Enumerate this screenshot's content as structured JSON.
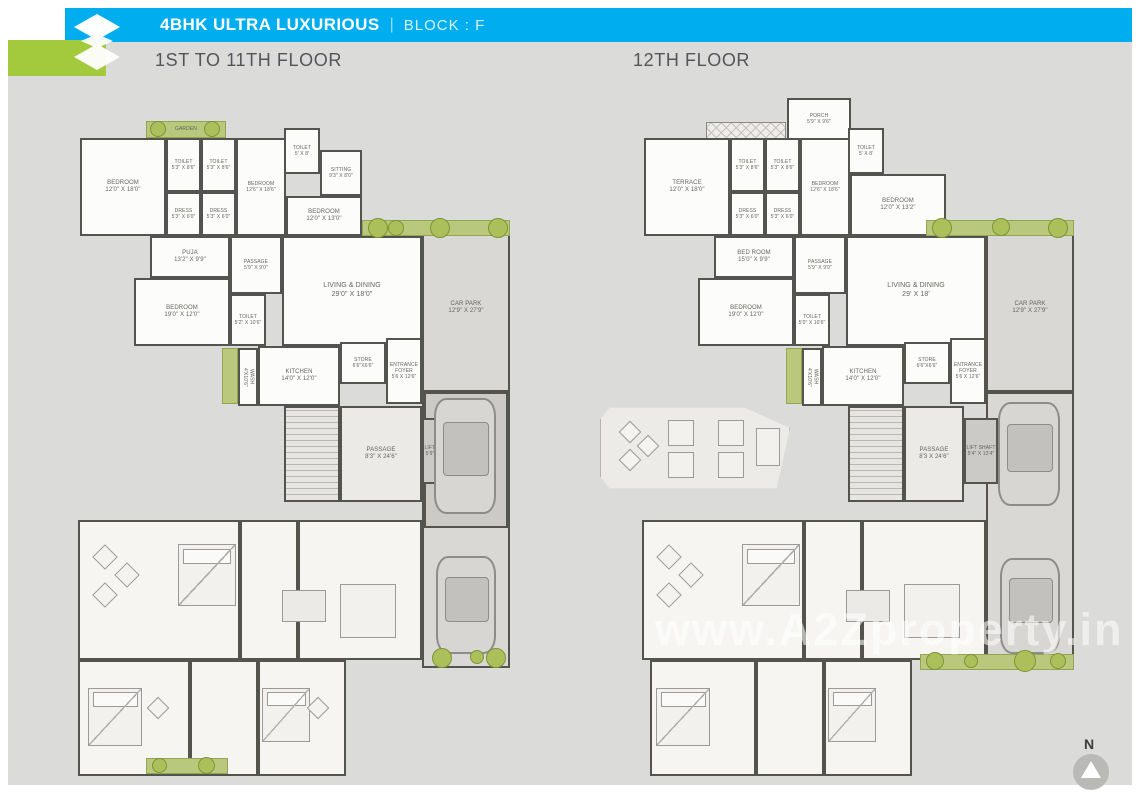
{
  "colors": {
    "header_blue": "#00adef",
    "logo_green": "#a3c93d",
    "canvas_gray": "#dbdbd9",
    "accent_green": "#abc05a",
    "wall": "#54544f"
  },
  "header": {
    "title": "4BHK ULTRA LUXURIOUS",
    "separator": "|",
    "block_label": "BLOCK : F"
  },
  "compass": {
    "label": "N"
  },
  "watermark": {
    "text": "www.A2Zproperty.in"
  },
  "plans": [
    {
      "id": "first-to-11th-floor",
      "title": "1ST TO 11TH FLOOR",
      "items": [
        {
          "k": "zone",
          "n": "CAR PARK",
          "d": "12'9\" X 27'9\"",
          "x": 422,
          "y": 224,
          "w": 88,
          "h": 168
        },
        {
          "k": "zone",
          "x": 422,
          "y": 392,
          "w": 88,
          "h": 276
        },
        {
          "k": "dark",
          "x": 424,
          "y": 392,
          "w": 84,
          "h": 136
        },
        {
          "k": "stairs",
          "x": 284,
          "y": 406,
          "w": 56,
          "h": 96
        },
        {
          "k": "pass",
          "n": "PASSAGE",
          "d": "8'3\" X 24'6\"",
          "x": 340,
          "y": 406,
          "w": 82,
          "h": 96
        },
        {
          "k": "dark",
          "n": "LIFT SHAFT",
          "d": "5'9\" X 12'6\"",
          "x": 422,
          "y": 418,
          "w": 34,
          "h": 66,
          "fs": 5
        },
        {
          "k": "green",
          "n": "GARDEN",
          "x": 146,
          "y": 121,
          "w": 80,
          "h": 17,
          "fs": 5
        },
        {
          "k": "room",
          "n": "BEDROOM",
          "d": "12'0\" X 18'0\"",
          "x": 80,
          "y": 138,
          "w": 86,
          "h": 98
        },
        {
          "k": "room",
          "n": "TOILET",
          "d": "5'3\" X 8'6\"",
          "x": 166,
          "y": 138,
          "w": 35,
          "h": 54,
          "fs": 5
        },
        {
          "k": "room",
          "n": "TOILET",
          "d": "5'3\" X 8'6\"",
          "x": 201,
          "y": 138,
          "w": 35,
          "h": 54,
          "fs": 5
        },
        {
          "k": "room",
          "n": "DRESS",
          "d": "5'3\" X 6'0\"",
          "x": 166,
          "y": 192,
          "w": 35,
          "h": 44,
          "fs": 5
        },
        {
          "k": "room",
          "n": "DRESS",
          "d": "5'3\" X 6'0\"",
          "x": 201,
          "y": 192,
          "w": 35,
          "h": 44,
          "fs": 5
        },
        {
          "k": "room",
          "n": "BEDROOM",
          "d": "12'6\" X 18'6\"",
          "x": 236,
          "y": 138,
          "w": 50,
          "h": 98,
          "fs": 5
        },
        {
          "k": "room",
          "n": "BEDROOM",
          "d": "12'0\" X 13'0\"",
          "x": 286,
          "y": 196,
          "w": 76,
          "h": 40
        },
        {
          "k": "room",
          "n": "TOILET",
          "d": "5' X 8'",
          "x": 284,
          "y": 128,
          "w": 36,
          "h": 46,
          "fs": 5
        },
        {
          "k": "room",
          "n": "SITTING",
          "d": "9'3\" X 8'0\"",
          "x": 320,
          "y": 150,
          "w": 42,
          "h": 46,
          "fs": 5
        },
        {
          "k": "room",
          "n": "PUJA",
          "d": "13'2\" X 9'9\"",
          "x": 150,
          "y": 236,
          "w": 80,
          "h": 42
        },
        {
          "k": "room",
          "n": "PASSAGE",
          "d": "5'9\" X 9'0\"",
          "x": 230,
          "y": 236,
          "w": 52,
          "h": 58,
          "fs": 5
        },
        {
          "k": "room",
          "n": "LIVING & DINING",
          "d": "29'0\" X 18'0\"",
          "x": 282,
          "y": 236,
          "w": 140,
          "h": 110,
          "fs": 7
        },
        {
          "k": "room",
          "n": "BEDROOM",
          "d": "19'0\" X 12'0\"",
          "x": 134,
          "y": 278,
          "w": 96,
          "h": 68
        },
        {
          "k": "room",
          "n": "TOILET",
          "d": "5'2\" X 10'6\"",
          "x": 230,
          "y": 294,
          "w": 36,
          "h": 52,
          "fs": 5
        },
        {
          "k": "green",
          "x": 222,
          "y": 348,
          "w": 16,
          "h": 56
        },
        {
          "k": "room",
          "n": "WASH",
          "d": "4'X10'6\"",
          "x": 238,
          "y": 348,
          "w": 20,
          "h": 58,
          "vert": true,
          "fs": 5
        },
        {
          "k": "room",
          "n": "KITCHEN",
          "d": "14'0\" X 12'0\"",
          "x": 258,
          "y": 346,
          "w": 82,
          "h": 60
        },
        {
          "k": "room",
          "n": "STORE",
          "d": "6'6\"X6'6\"",
          "x": 340,
          "y": 342,
          "w": 46,
          "h": 42,
          "fs": 5
        },
        {
          "k": "room",
          "n": "ENTRANCE FOYER",
          "d": "5'6 X 12'6\"",
          "x": 386,
          "y": 338,
          "w": 36,
          "h": 66,
          "fs": 5
        },
        {
          "k": "label",
          "n": "CAR LIFT",
          "d": "20.5 X 12'9\"",
          "x": 426,
          "y": 484,
          "w": 80,
          "h": 20,
          "fs": 5
        },
        {
          "k": "soft",
          "x": 78,
          "y": 520,
          "w": 162,
          "h": 140
        },
        {
          "k": "soft",
          "x": 240,
          "y": 520,
          "w": 58,
          "h": 140
        },
        {
          "k": "soft",
          "x": 298,
          "y": 520,
          "w": 124,
          "h": 140
        },
        {
          "k": "soft",
          "x": 78,
          "y": 660,
          "w": 112,
          "h": 116
        },
        {
          "k": "soft",
          "x": 190,
          "y": 660,
          "w": 68,
          "h": 116
        },
        {
          "k": "soft",
          "x": 258,
          "y": 660,
          "w": 88,
          "h": 116
        },
        {
          "k": "bed",
          "x": 178,
          "y": 544,
          "w": 58,
          "h": 62
        },
        {
          "k": "dia",
          "x": 96,
          "y": 548,
          "w": 18,
          "h": 18
        },
        {
          "k": "dia",
          "x": 118,
          "y": 566,
          "w": 18,
          "h": 18
        },
        {
          "k": "dia",
          "x": 96,
          "y": 586,
          "w": 18,
          "h": 18
        },
        {
          "k": "table",
          "x": 282,
          "y": 590,
          "w": 44,
          "h": 32
        },
        {
          "k": "furn",
          "x": 340,
          "y": 584,
          "w": 56,
          "h": 54
        },
        {
          "k": "bed",
          "x": 88,
          "y": 688,
          "w": 54,
          "h": 58
        },
        {
          "k": "bed",
          "x": 262,
          "y": 688,
          "w": 48,
          "h": 54
        },
        {
          "k": "dia",
          "x": 150,
          "y": 700,
          "w": 16,
          "h": 16
        },
        {
          "k": "dia",
          "x": 310,
          "y": 700,
          "w": 16,
          "h": 16
        },
        {
          "k": "car",
          "x": 434,
          "y": 398,
          "w": 62,
          "h": 116
        },
        {
          "k": "car",
          "x": 436,
          "y": 556,
          "w": 60,
          "h": 98
        },
        {
          "k": "green",
          "x": 362,
          "y": 220,
          "w": 148,
          "h": 16
        },
        {
          "k": "dot",
          "x": 368,
          "y": 218,
          "w": 20,
          "h": 20
        },
        {
          "k": "dot",
          "x": 388,
          "y": 220,
          "w": 16,
          "h": 16
        },
        {
          "k": "dot",
          "x": 430,
          "y": 218,
          "w": 20,
          "h": 20
        },
        {
          "k": "dot",
          "x": 488,
          "y": 218,
          "w": 20,
          "h": 20
        },
        {
          "k": "dot",
          "x": 150,
          "y": 121,
          "w": 16,
          "h": 16
        },
        {
          "k": "dot",
          "x": 204,
          "y": 121,
          "w": 16,
          "h": 16
        },
        {
          "k": "dot",
          "x": 432,
          "y": 648,
          "w": 20,
          "h": 20
        },
        {
          "k": "dot",
          "x": 470,
          "y": 650,
          "w": 14,
          "h": 14
        },
        {
          "k": "dot",
          "x": 486,
          "y": 648,
          "w": 20,
          "h": 20
        },
        {
          "k": "green",
          "x": 146,
          "y": 758,
          "w": 82,
          "h": 16
        },
        {
          "k": "dot",
          "x": 152,
          "y": 758,
          "w": 15,
          "h": 15
        },
        {
          "k": "dot",
          "x": 198,
          "y": 757,
          "w": 17,
          "h": 17
        }
      ]
    },
    {
      "id": "twelfth-floor",
      "title": "12TH FLOOR",
      "items": [
        {
          "k": "zone",
          "n": "CAR PARK",
          "d": "12'9\" X 27'9\"",
          "x": 986,
          "y": 224,
          "w": 88,
          "h": 168
        },
        {
          "k": "zone",
          "x": 986,
          "y": 392,
          "w": 88,
          "h": 276
        },
        {
          "k": "stairs",
          "x": 848,
          "y": 406,
          "w": 56,
          "h": 96
        },
        {
          "k": "pass",
          "n": "PASSAGE",
          "d": "8'3 X 24'6\"",
          "x": 904,
          "y": 406,
          "w": 60,
          "h": 96
        },
        {
          "k": "dark",
          "n": "LIFT SHAFT",
          "d": "5'4\" X 13'4\"",
          "x": 964,
          "y": 418,
          "w": 34,
          "h": 66,
          "fs": 5
        },
        {
          "k": "deck",
          "x": 600,
          "y": 406,
          "w": 190,
          "h": 84
        },
        {
          "k": "dia",
          "x": 622,
          "y": 424,
          "w": 16,
          "h": 16
        },
        {
          "k": "dia",
          "x": 640,
          "y": 438,
          "w": 16,
          "h": 16
        },
        {
          "k": "dia",
          "x": 622,
          "y": 452,
          "w": 16,
          "h": 16
        },
        {
          "k": "furn",
          "x": 668,
          "y": 420,
          "w": 26,
          "h": 26
        },
        {
          "k": "furn",
          "x": 718,
          "y": 420,
          "w": 26,
          "h": 26
        },
        {
          "k": "furn",
          "x": 668,
          "y": 452,
          "w": 26,
          "h": 26
        },
        {
          "k": "furn",
          "x": 718,
          "y": 452,
          "w": 26,
          "h": 26
        },
        {
          "k": "furn",
          "x": 756,
          "y": 428,
          "w": 24,
          "h": 38
        },
        {
          "k": "hatchx",
          "x": 706,
          "y": 122,
          "w": 80,
          "h": 18
        },
        {
          "k": "room",
          "n": "PORCH",
          "d": "5'9\" X 9'6\"",
          "x": 787,
          "y": 98,
          "w": 64,
          "h": 42,
          "fs": 5
        },
        {
          "k": "room",
          "n": "TERRACE",
          "d": "12'0\" X 18'0\"",
          "x": 644,
          "y": 138,
          "w": 86,
          "h": 98
        },
        {
          "k": "room",
          "n": "TOILET",
          "d": "5'3\" X 8'6\"",
          "x": 730,
          "y": 138,
          "w": 35,
          "h": 54,
          "fs": 5
        },
        {
          "k": "room",
          "n": "TOILET",
          "d": "5'3\" X 8'6\"",
          "x": 765,
          "y": 138,
          "w": 35,
          "h": 54,
          "fs": 5
        },
        {
          "k": "room",
          "n": "DRESS",
          "d": "5'3\" X 6'0\"",
          "x": 730,
          "y": 192,
          "w": 35,
          "h": 44,
          "fs": 5
        },
        {
          "k": "room",
          "n": "DRESS",
          "d": "5'3\" X 6'0\"",
          "x": 765,
          "y": 192,
          "w": 35,
          "h": 44,
          "fs": 5
        },
        {
          "k": "room",
          "n": "BEDROOM",
          "d": "12'6\" X 18'6\"",
          "x": 800,
          "y": 138,
          "w": 50,
          "h": 98,
          "fs": 5
        },
        {
          "k": "room",
          "n": "BEDROOM",
          "d": "12'0\" X 13'2\"",
          "x": 850,
          "y": 174,
          "w": 96,
          "h": 62
        },
        {
          "k": "room",
          "n": "TOILET",
          "d": "5' X 8'",
          "x": 848,
          "y": 128,
          "w": 36,
          "h": 46,
          "fs": 5
        },
        {
          "k": "room",
          "n": "BED ROOM",
          "d": "15'0\" X 9'9\"",
          "x": 714,
          "y": 236,
          "w": 80,
          "h": 42
        },
        {
          "k": "room",
          "n": "PASSAGE",
          "d": "5'9\" X 9'0\"",
          "x": 794,
          "y": 236,
          "w": 52,
          "h": 58,
          "fs": 5
        },
        {
          "k": "room",
          "n": "LIVING & DINING",
          "d": "29' X 18'",
          "x": 846,
          "y": 236,
          "w": 140,
          "h": 110,
          "fs": 7
        },
        {
          "k": "room",
          "n": "BEDROOM",
          "d": "19'0\" X 12'0\"",
          "x": 698,
          "y": 278,
          "w": 96,
          "h": 68
        },
        {
          "k": "room",
          "n": "TOILET",
          "d": "5'0\" X 10'6\"",
          "x": 794,
          "y": 294,
          "w": 36,
          "h": 52,
          "fs": 5
        },
        {
          "k": "green",
          "x": 786,
          "y": 348,
          "w": 16,
          "h": 56
        },
        {
          "k": "room",
          "n": "WASH",
          "d": "4'X10'6\"",
          "x": 802,
          "y": 348,
          "w": 20,
          "h": 58,
          "vert": true,
          "fs": 5
        },
        {
          "k": "room",
          "n": "KITCHEN",
          "d": "14'0\" X 12'0\"",
          "x": 822,
          "y": 346,
          "w": 82,
          "h": 60
        },
        {
          "k": "room",
          "n": "STORE",
          "d": "6'6\"X6'6\"",
          "x": 904,
          "y": 342,
          "w": 46,
          "h": 42,
          "fs": 5
        },
        {
          "k": "room",
          "n": "ENTRANCE FOYER",
          "d": "5'6 X 12'6\"",
          "x": 950,
          "y": 338,
          "w": 36,
          "h": 66,
          "fs": 5
        },
        {
          "k": "soft",
          "x": 642,
          "y": 520,
          "w": 162,
          "h": 140
        },
        {
          "k": "soft",
          "x": 804,
          "y": 520,
          "w": 58,
          "h": 140
        },
        {
          "k": "soft",
          "x": 862,
          "y": 520,
          "w": 124,
          "h": 140
        },
        {
          "k": "soft",
          "x": 650,
          "y": 660,
          "w": 106,
          "h": 116
        },
        {
          "k": "soft",
          "x": 756,
          "y": 660,
          "w": 68,
          "h": 116
        },
        {
          "k": "soft",
          "x": 824,
          "y": 660,
          "w": 88,
          "h": 116
        },
        {
          "k": "bed",
          "x": 742,
          "y": 544,
          "w": 58,
          "h": 62
        },
        {
          "k": "dia",
          "x": 660,
          "y": 548,
          "w": 18,
          "h": 18
        },
        {
          "k": "dia",
          "x": 682,
          "y": 566,
          "w": 18,
          "h": 18
        },
        {
          "k": "dia",
          "x": 660,
          "y": 586,
          "w": 18,
          "h": 18
        },
        {
          "k": "table",
          "x": 846,
          "y": 590,
          "w": 44,
          "h": 32
        },
        {
          "k": "furn",
          "x": 904,
          "y": 584,
          "w": 56,
          "h": 54
        },
        {
          "k": "bed",
          "x": 656,
          "y": 688,
          "w": 54,
          "h": 58
        },
        {
          "k": "bed",
          "x": 828,
          "y": 688,
          "w": 48,
          "h": 54
        },
        {
          "k": "car",
          "x": 998,
          "y": 402,
          "w": 62,
          "h": 104
        },
        {
          "k": "car",
          "x": 1000,
          "y": 558,
          "w": 60,
          "h": 96
        },
        {
          "k": "green",
          "x": 926,
          "y": 220,
          "w": 148,
          "h": 16
        },
        {
          "k": "dot",
          "x": 932,
          "y": 218,
          "w": 20,
          "h": 20
        },
        {
          "k": "dot",
          "x": 992,
          "y": 218,
          "w": 18,
          "h": 18
        },
        {
          "k": "dot",
          "x": 1048,
          "y": 218,
          "w": 20,
          "h": 20
        },
        {
          "k": "green",
          "x": 920,
          "y": 654,
          "w": 154,
          "h": 16
        },
        {
          "k": "dot",
          "x": 926,
          "y": 652,
          "w": 18,
          "h": 18
        },
        {
          "k": "dot",
          "x": 964,
          "y": 654,
          "w": 14,
          "h": 14
        },
        {
          "k": "dot",
          "x": 1014,
          "y": 650,
          "w": 22,
          "h": 22
        },
        {
          "k": "dot",
          "x": 1050,
          "y": 653,
          "w": 16,
          "h": 16
        }
      ]
    }
  ]
}
